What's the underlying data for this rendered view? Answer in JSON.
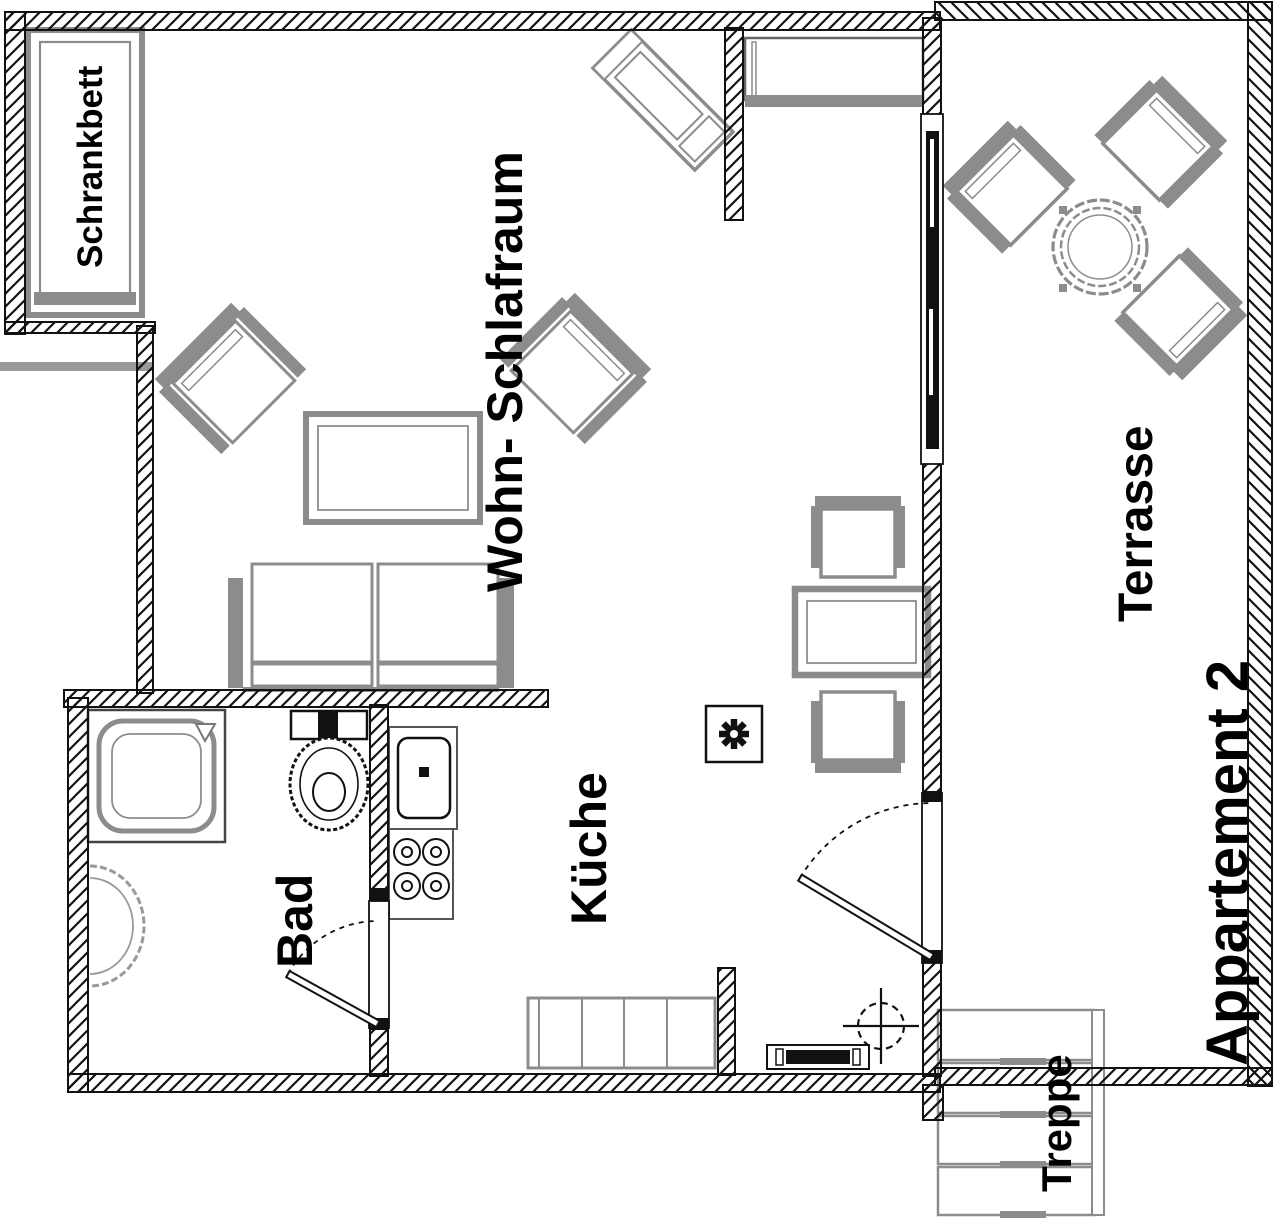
{
  "title": "Appartement 2",
  "labels": {
    "schrankbett": "Schrankbett",
    "wohn_schlafraum": "Wohn- Schlafraum",
    "kueche": "Küche",
    "bad": "Bad",
    "terrasse": "Terrasse",
    "appartement": "Appartement 2",
    "treppe": "Treppe"
  },
  "colors": {
    "wall": "#000000",
    "furniture": "#8c8c8c",
    "background": "#ffffff",
    "text": "#000000"
  }
}
